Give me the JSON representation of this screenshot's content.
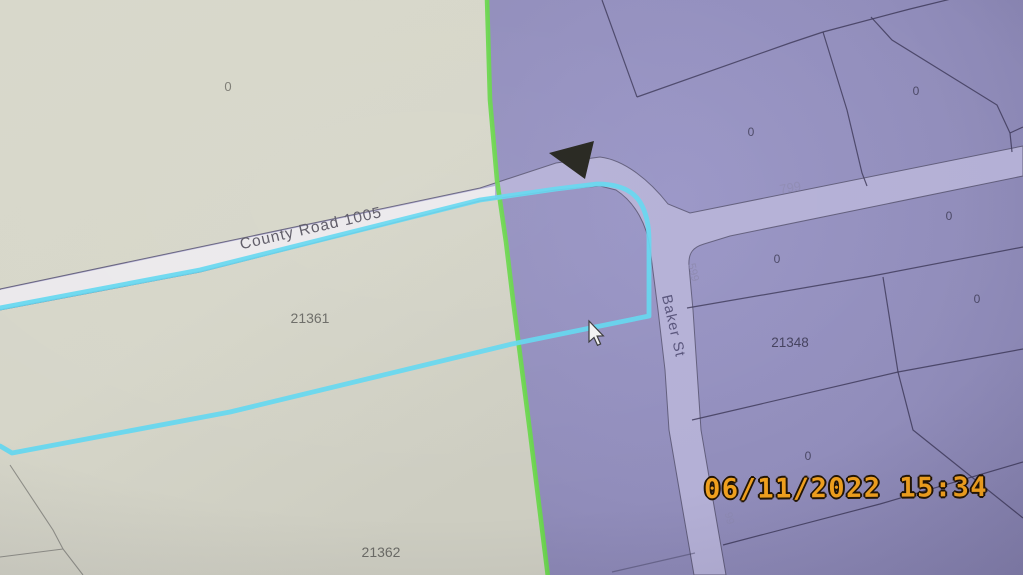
{
  "map": {
    "road_labels": {
      "county_road_1005": "County Road 1005",
      "route_799": "799",
      "baker_st": "Baker St",
      "baker_route_599": "599",
      "baker_route_99": "99"
    },
    "parcel_labels": {
      "left_parcel_zero": "0",
      "parcel_21361": "21361",
      "parcel_21362": "21362",
      "parcel_21348": "21348",
      "zeros": [
        "0",
        "0",
        "0",
        "0",
        "0",
        "0"
      ]
    },
    "colors": {
      "selection_highlight_cyan": "#63d7f0",
      "boundary_green": "#69d74c",
      "left_region_cream": "#d6d6c9",
      "right_region_purple": "#918dbb",
      "road_fill_purple": "#b4b0d6",
      "road_fill_white": "#ebe9ec",
      "parcel_line": "#3f3b5c",
      "timestamp_orange": "#f0a01e"
    }
  },
  "camera_overlay": {
    "timestamp": "06/11/2022 15:34"
  }
}
